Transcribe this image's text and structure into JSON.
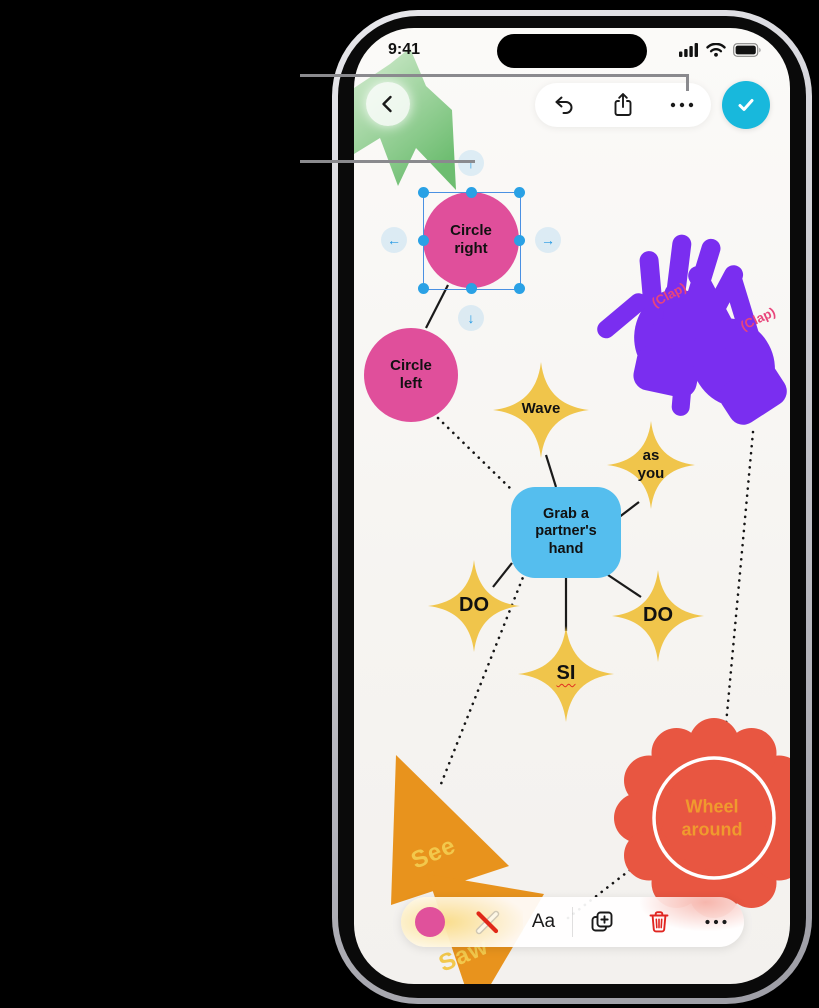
{
  "status_bar": {
    "time": "9:41",
    "signal_icon": "signal-bars",
    "wifi_icon": "wifi",
    "battery_icon": "battery-full"
  },
  "top_toolbar": {
    "back_icon": "chevron-back",
    "undo_icon": "undo-arrow",
    "share_icon": "share",
    "more_icon": "ellipsis",
    "done_icon": "checkmark"
  },
  "selection": {
    "arrow_up": "↑",
    "arrow_down": "↓",
    "arrow_left": "←",
    "arrow_right": "→"
  },
  "shapes": {
    "circle_right": "Circle\nright",
    "circle_left": "Circle\nleft",
    "clap_left": "(Clap)",
    "clap_right": "(Clap)",
    "wave": "Wave",
    "as_you": "as\nyou",
    "grab": "Grab a\npartner's\nhand",
    "do_left": "DO",
    "do_right": "DO",
    "si": "SI",
    "see": "See",
    "saw": "Saw",
    "wheel": "Wheel\naround"
  },
  "bottom_toolbar": {
    "color_swatch": "pink-fill",
    "line_style_icon": "line-style",
    "text_button": "Aa",
    "duplicate_icon": "duplicate",
    "delete_icon": "trash",
    "more_icon": "ellipsis"
  },
  "colors": {
    "pink": "#E04F9B",
    "yellow": "#F0C54B",
    "blue": "#55BEEE",
    "purple": "#7A2EF0",
    "red_shape": "#E85641",
    "orange": "#E8931D",
    "cyan_done": "#18B8DC",
    "clap_text": "#E8457B",
    "wheel_text": "#F09A2E",
    "trash_red": "#E02520",
    "selection_blue": "#2AA1E5"
  }
}
